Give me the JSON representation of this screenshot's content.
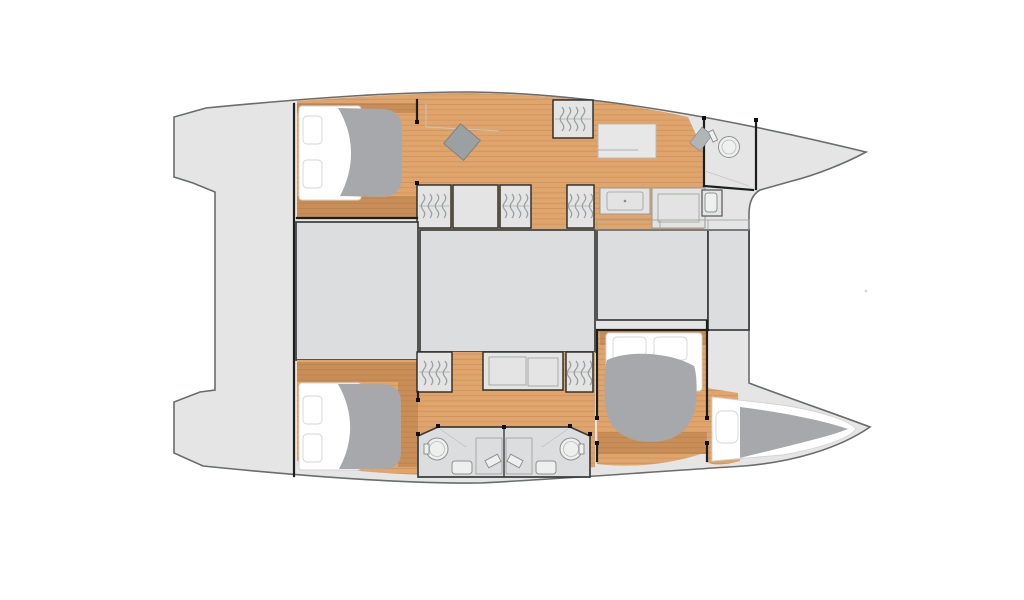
{
  "plan": {
    "type": "catamaran-interior-floor-plan",
    "orientation": {
      "bow": "right",
      "stern": "left"
    },
    "hull_top": [
      "aft-double-cabin",
      "desk-area",
      "wardrobe-row",
      "forward-berth",
      "bow-bathroom",
      "wc"
    ],
    "hull_bottom": [
      "aft-double-cabin",
      "wardrobe-galley-row",
      "twin-bathrooms",
      "forward-double-cabin",
      "bow-berth"
    ],
    "center_deck_blocks": 4
  },
  "icons": {
    "wardrobe_hangers": "vertical wavy strokes",
    "sink": "circle with inner ring",
    "toilet": "small rounded rectangle",
    "shower_seat": "angled rectangle",
    "desk_chair": "rotated square"
  },
  "colors": {
    "background": "#ffffff",
    "deck": "#e4e5e4",
    "deck_stroke": "#6a6d6c",
    "block": "#dcddde",
    "block_stroke": "#3b3d3d",
    "wood": "#e0a56c",
    "wood_plank": "#c78c55",
    "wood_dark": "#c98e58",
    "wood_dark_plank": "#b37c46",
    "wall": "#1d1e1e",
    "bedding_white": "#ffffff",
    "duvet": "#a6a8ab",
    "furniture": "#e3e4e3",
    "fixture": "#eef0ef",
    "hanger": "#9b9fa1",
    "seat": "#9ba0a3"
  }
}
